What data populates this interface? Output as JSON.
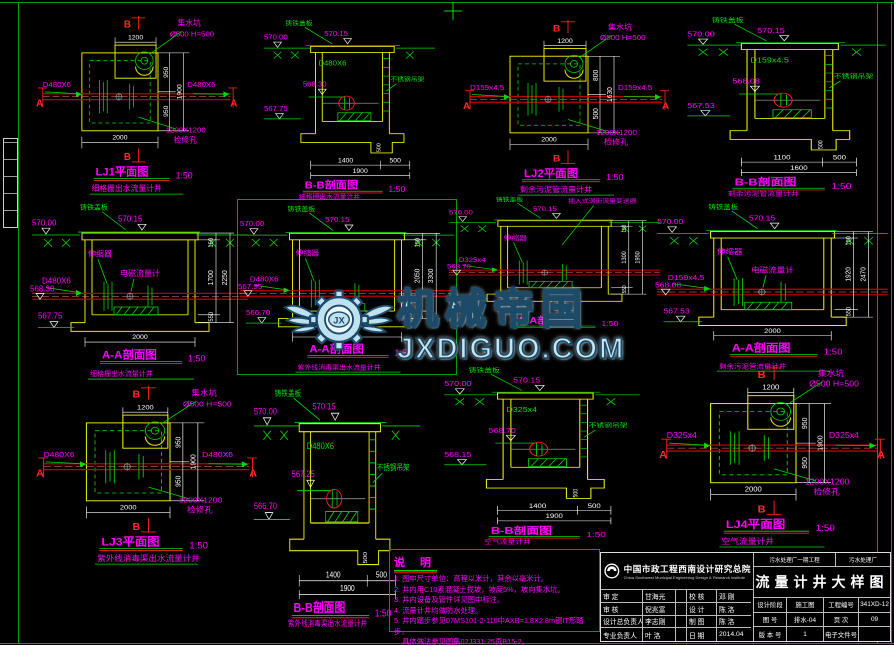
{
  "sheet": {
    "bg": "#000000",
    "frame_color": "#00a000"
  },
  "watermark": {
    "text_cn": "机械帝国",
    "text_en": "JXDIGUO.COM",
    "logo_letters": "JX"
  },
  "panels": [
    {
      "title": "LJ1平面图",
      "scale": "1:50",
      "subtitle": "细格栅出水流量计井",
      "mA": "A",
      "mB": "B",
      "pipe_left": "D480X6",
      "pipe_right": "D480X6",
      "sump1": "集水坑",
      "sump2": "Ø500 H=500",
      "hatch1": "1200X1200",
      "hatch2": "检修孔",
      "dim_top": "1200",
      "dim_bottom": "2000",
      "dim_r1": "950",
      "dim_r2": "950",
      "dim_rt": "1900"
    },
    {
      "title": "B-B剖面图",
      "scale": "1:50",
      "subtitle": "细格栅出水流量计井",
      "cover": "铸铁盖板",
      "pipe": "D480X6",
      "bracket": "不锈钢吊架",
      "e_ground": "570.00",
      "e_top": "570.15",
      "e_pipe": "568.30",
      "e_floor": "567.75",
      "d1": "1400",
      "d2": "500",
      "dt": "1900",
      "d_sump": "500"
    },
    {
      "title": "LJ2平面图",
      "scale": "1:50",
      "subtitle": "剩余污泥管流量计井",
      "mA": "A",
      "mB": "B",
      "pipe_left": "D159x4.5",
      "pipe_right": "D159x4.5",
      "sump1": "集水坑",
      "sump2": "Ø500 H=500",
      "hatch1": "1200X1200",
      "hatch2": "检修孔",
      "dim_top": "1200",
      "dim_bottom": "2000",
      "dim_r1": "800",
      "dim_r2": "500",
      "dim_rt": "1630"
    },
    {
      "title": "B-B剖面图",
      "scale": "1:50",
      "subtitle": "剩余污泥管流量计井",
      "cover": "铸铁盖板",
      "pipe": "D159x4.5",
      "bracket": "不锈钢吊架",
      "e_ground": "570.00",
      "e_top": "570.15",
      "e_pipe": "568.08",
      "e_floor": "567.53",
      "d1": "1100",
      "d2": "500",
      "dt": "1600",
      "d_sump": "500"
    },
    {
      "title": "A-A剖面图",
      "scale": "1:50",
      "subtitle": "细格栅出水流量计井",
      "cover": "铸铁盖板",
      "exp": "伸缩器",
      "meter": "电磁流量计",
      "vortex": "",
      "pipe": "D480X6",
      "e_ground": "570.00",
      "e_top": "570.15",
      "e_pipe": "568.30",
      "e_floor": "567.75",
      "dim_r1": "150",
      "dim_r2": "1700",
      "dim_r3": "550",
      "dim_rt": "2250",
      "dim_bottom": "2000"
    },
    {
      "title": "A-A剖面图",
      "scale": "1:50",
      "subtitle": "紫外线消毒渠出水流量计井",
      "cover": "铸铁盖板",
      "exp": "伸缩器",
      "meter": "",
      "vortex": "",
      "pipe": "D480X6",
      "e_ground": "570.00",
      "e_top": "570.15",
      "e_pipe": "567.95",
      "e_floor": "566.70",
      "dim_r1": "150",
      "dim_r2": "2050",
      "dim_r3": "550",
      "dim_rt": "3300",
      "dim_bottom": "2000"
    },
    {
      "title": "A-A剖面图",
      "scale": "1:50",
      "subtitle": "",
      "cover": "铸铁盖板",
      "exp": "伸缩器",
      "meter": "",
      "vortex": "插入式涡街流量变送器",
      "pipe": "D325x4",
      "e_ground": "570.00",
      "e_top": "570.15",
      "e_pipe": "568.70",
      "e_floor": "",
      "dim_r1": "150",
      "dim_r2": "1300",
      "dim_r3": "550",
      "dim_rt": "1950",
      "dim_bottom": ""
    },
    {
      "title": "A-A剖面图",
      "scale": "1:50",
      "subtitle": "剩余污泥管流量计井",
      "cover": "铸铁盖板",
      "exp": "伸缩器",
      "meter": "电磁流量计",
      "vortex": "",
      "pipe": "D159x4.5",
      "e_ground": "570.00",
      "e_top": "570.15",
      "e_pipe": "568.08",
      "e_floor": "567.53",
      "dim_r1": "150",
      "dim_r2": "1920",
      "dim_r3": "550",
      "dim_rt": "2470",
      "dim_bottom": "2000"
    },
    {
      "title": "LJ3平面图",
      "scale": "1:50",
      "subtitle": "紫外线消毒渠出水流量计井",
      "mA": "A",
      "mB": "B",
      "pipe_left": "D480X6",
      "pipe_right": "D480X6",
      "sump1": "集水坑",
      "sump2": "Ø500 H=500",
      "hatch1": "1200X1200",
      "hatch2": "检修孔",
      "dim_top": "1200",
      "dim_bottom": "2000",
      "dim_r1": "950",
      "dim_r2": "950",
      "dim_rt": "1900"
    },
    {
      "title": "B-B剖面图",
      "scale": "1:50",
      "subtitle": "紫外线消毒渠出水流量计井",
      "cover": "铸铁盖板",
      "pipe": "D480X6",
      "bracket": "不锈钢吊架",
      "e_ground": "570.00",
      "e_top": "570.15",
      "e_pipe": "567.25",
      "e_floor": "566.70",
      "d1": "1400",
      "d2": "500",
      "dt": "1900",
      "d_sump": "500"
    },
    {
      "title": "B-B剖面图",
      "scale": "1:50",
      "subtitle": "空气流量计井",
      "cover": "铸铁盖板",
      "pipe": "D325x4",
      "bracket": "不锈钢吊架",
      "e_ground": "570.00",
      "e_top": "570.15",
      "e_pipe": "568.70",
      "e_floor": "568.15",
      "d1": "1400",
      "d2": "500",
      "dt": "1900",
      "d_sump": "500"
    },
    {
      "title": "LJ4平面图",
      "scale": "1:50",
      "subtitle": "空气流量计井",
      "mA": "A",
      "mB": "B",
      "pipe_left": "D325x4",
      "pipe_right": "D325x4",
      "sump1": "集水坑",
      "sump2": "Ø500 H=500",
      "hatch1": "1200X1200",
      "hatch2": "检修孔",
      "dim_top": "1200",
      "dim_bottom": "2000",
      "dim_r1": "950",
      "dim_r2": "950",
      "dim_rt": "1900"
    }
  ],
  "notes": {
    "title": "说 明",
    "items": [
      "1. 图中尺寸单位：高程以米计，其余以毫米计。",
      "2. 井内用C10素混凝土找坡，坡度5%，坡向集水坑。",
      "3. 井内设备及管件详见图中标注。",
      "4. 流量计井均做防水处理。",
      "5. 井内踏步参见07MS101-2-110中AXB=1.8X2.8m钢IT形踏步，",
      "    具体做法参见图集02J331-25页B15-2。"
    ]
  },
  "titleblock": {
    "company": "中国市政工程西南设计研究总院",
    "company_en": "China Southwest Municipal Engineering Design & Research Institute",
    "project": "污水处理厂一期工程",
    "plant": "污水处理厂",
    "drawing_title": "流量计井大样图",
    "rows_left": [
      [
        "审 定",
        "甘海光",
        "校 核",
        "邓 刚"
      ],
      [
        "审 核",
        "倪兆富",
        "设 计",
        "陈 洛"
      ],
      [
        "设计总负责人",
        "李志刚",
        "制 图",
        "陈 洛"
      ],
      [
        "专业负责人",
        "叶 洛",
        "日 期",
        "2014.04"
      ]
    ],
    "meta": [
      [
        "设计阶段",
        "施工图",
        "工程编号",
        "341XD-12"
      ],
      [
        "图 号",
        "排水-04",
        "页 次",
        "09"
      ],
      [
        "版 本 号",
        "1",
        "电子文件号",
        ""
      ]
    ]
  }
}
